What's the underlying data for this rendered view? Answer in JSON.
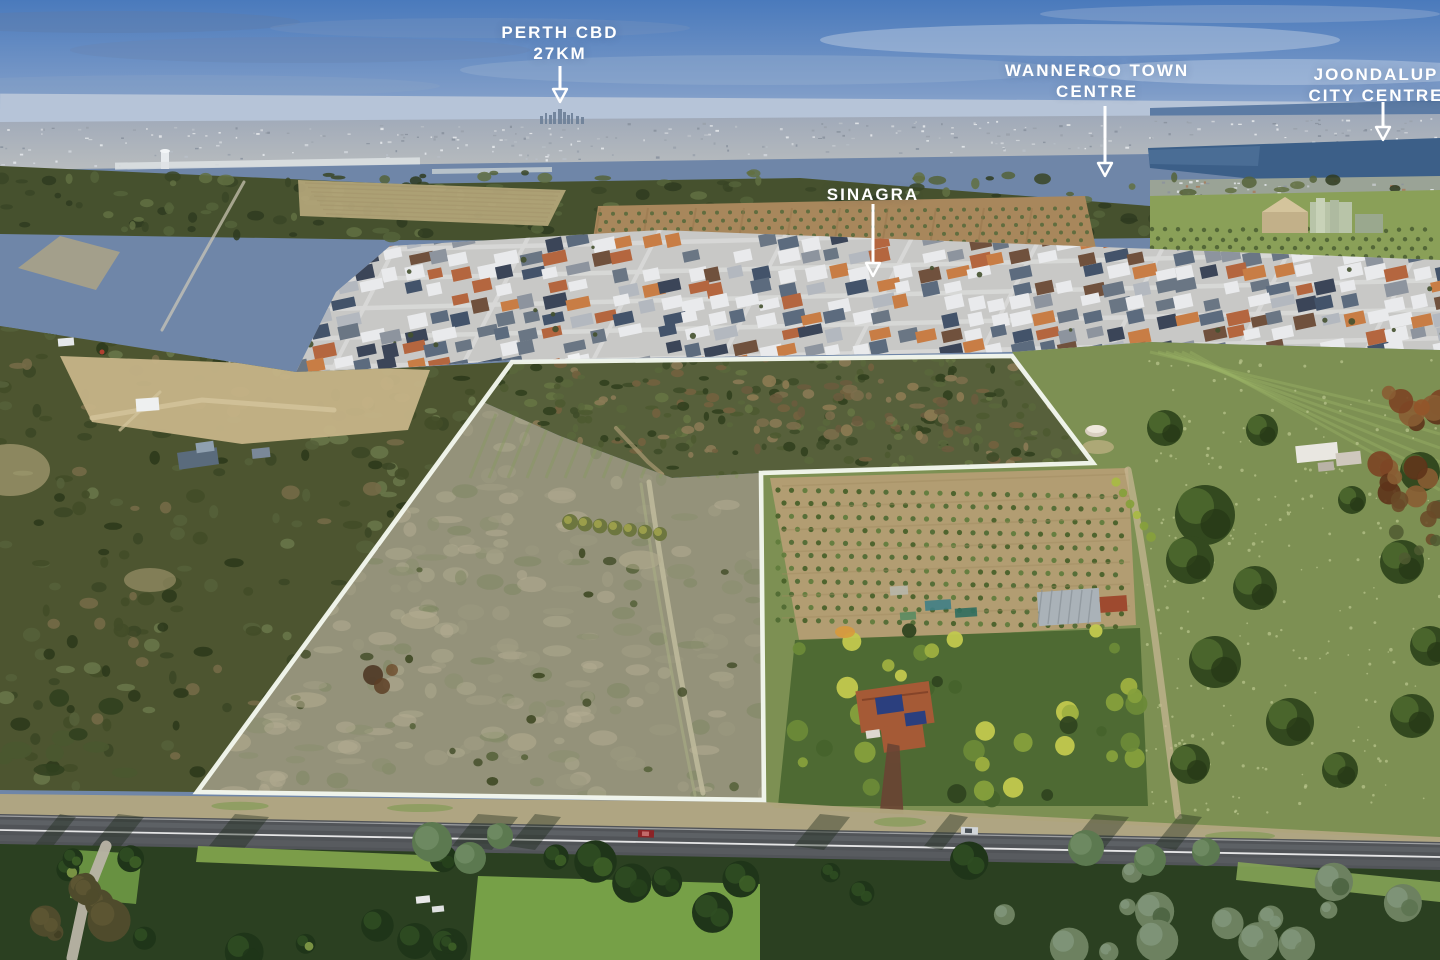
{
  "photo": {
    "annotations": {
      "perth_cbd": {
        "line1": "PERTH CBD",
        "line2": "27KM"
      },
      "wanneroo": {
        "line1": "WANNEROO TOWN",
        "line2": "CENTRE"
      },
      "sinagra": {
        "line1": "SINAGRA"
      },
      "joondalup": {
        "line1": "JOONDALUP",
        "line2": "CITY CENTRE"
      }
    },
    "boundary_outline": {
      "color": "#f4f8ee",
      "points": [
        [
          512,
          362
        ],
        [
          1012,
          356
        ],
        [
          1093,
          463
        ],
        [
          761,
          473
        ],
        [
          764,
          800
        ],
        [
          197,
          792
        ]
      ]
    },
    "palette": {
      "sky_top": "#4a7abc",
      "sky_mid": "#7e9cc8",
      "sky_horizon": "#aabdd8",
      "ocean": "#4c6f9b",
      "sprawl": "#a6aeb8",
      "lake": "#3c5f88",
      "tree_band": "#46512e",
      "field_green": "#8aa058",
      "orchard_soil": "#a8875c",
      "suburb_base": "#c8c8c6",
      "street": "#d8d9d7",
      "roof_colors": [
        "#e9eaec",
        "#e9eaec",
        "#e9eaec",
        "#b3b8bf",
        "#8d949e",
        "#5c6b7e",
        "#43536a",
        "#6a7684",
        "#b4663f",
        "#c87d45",
        "#3b4558",
        "#70513d"
      ],
      "paddock": "#94927a",
      "bush": "#57603b",
      "east_field": "#7d9053",
      "neighbor_soil": "#b29d72",
      "road": "#515458",
      "road_line": "#ffffff",
      "shoulder": "#b2a67f",
      "bottom_veg": "#2b4021",
      "grass_bright": "#76a047",
      "annotation_text": "#ffffff"
    }
  }
}
